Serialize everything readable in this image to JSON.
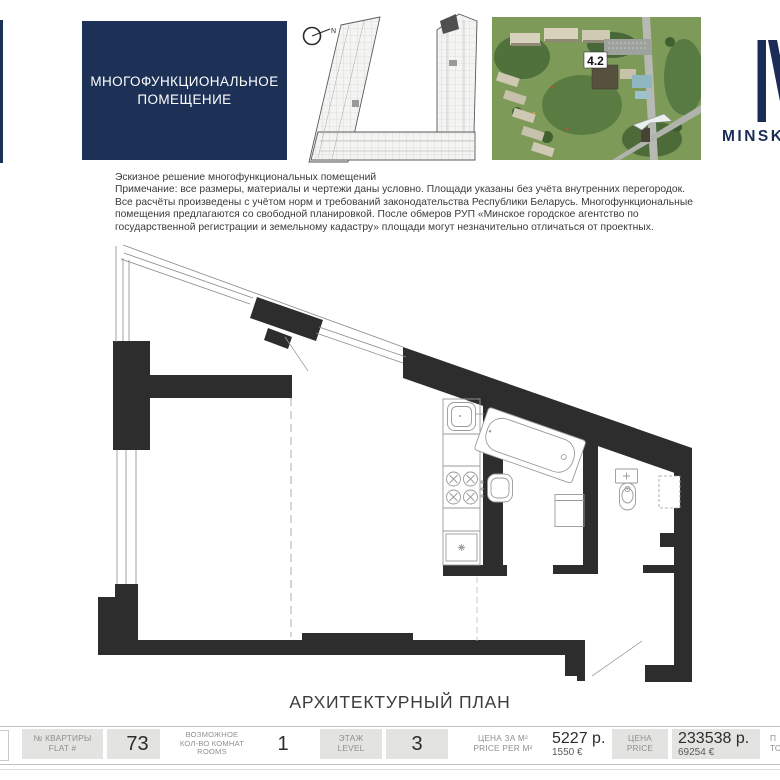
{
  "colors": {
    "accent_navy": "#1d3156",
    "logo_navy": "#1b2d56",
    "wall_black": "#2d2d2d",
    "footer_box_gray": "#e3e3e1"
  },
  "header": {
    "premises_box": {
      "line1": "МНОГОФУНКЦИОНАЛЬНОЕ",
      "line2": "ПОМЕЩЕНИЕ"
    },
    "north_label": "N",
    "site_badge": "4.2",
    "logo_text": "MINSK"
  },
  "notes": {
    "line1": "Эскизное решение многофункциональных помещений",
    "line2": "Примечание: все размеры, материалы и чертежи даны условно. Площади указаны без учёта внутренних перегородок.",
    "line3": "Все расчёты произведены с учётом норм и требований законодательства Республики Беларусь. Многофункциональные",
    "line4": "помещения предлагаются со свободной планировкой. После обмеров РУП «Минское городское агентство по",
    "line5": "государственной регистрации и земельному кадастру» площади могут незначительно отличаться от проектных."
  },
  "plan": {
    "title": "АРХИТЕКТУРНЫЙ ПЛАН"
  },
  "footer": {
    "flat": {
      "label1": "№ КВАРТИРЫ",
      "label2": "FLAT #",
      "value": "73"
    },
    "rooms": {
      "label1": "ВОЗМОЖНОЕ",
      "label2": "КОЛ-ВО КОМНАТ",
      "label3": "ROOMS",
      "value": "1"
    },
    "level": {
      "label1": "ЭТАЖ",
      "label2": "LEVEL",
      "value": "3"
    },
    "price_per_m2": {
      "label1": "ЦЕНА ЗА М²",
      "label2": "PRICE PER M²",
      "value_byn": "5227 р.",
      "value_eur": "1550 €"
    },
    "price": {
      "label1": "ЦЕНА",
      "label2": "PRICE",
      "value_byn": "233538 р.",
      "value_eur": "69254 €"
    },
    "clipped": {
      "label1": "П",
      "label2": "ТО"
    }
  }
}
